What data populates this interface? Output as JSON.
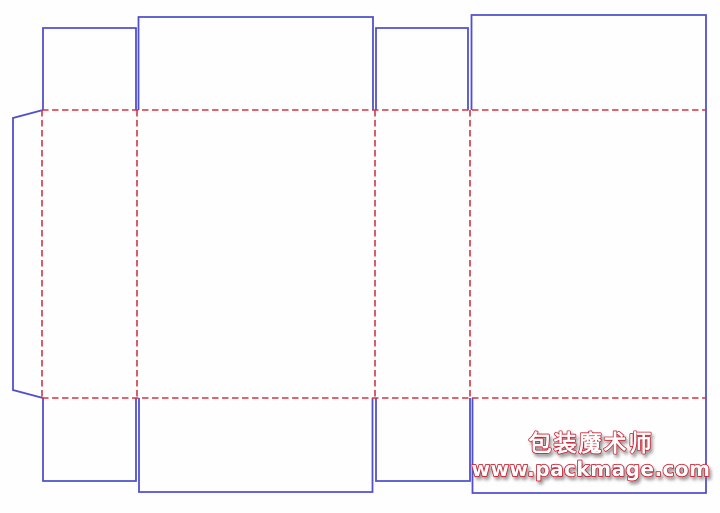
{
  "canvas": {
    "width": 720,
    "height": 513,
    "background": "#fefefe"
  },
  "colors": {
    "cut_line": "#5050cb",
    "fold_line": "#cf3745",
    "watermark_fill": "#ffffff",
    "watermark_outline": "#cc2233"
  },
  "dieline": {
    "stroke_width_cut": 1.8,
    "stroke_width_fold": 1.6,
    "fold_dash": "6.5 3.5",
    "cut_lines": [
      {
        "name": "glue-flap",
        "points": [
          [
            43,
            110
          ],
          [
            13,
            118
          ],
          [
            13,
            390
          ],
          [
            43,
            398
          ]
        ]
      },
      {
        "name": "top-dust-flap-left",
        "points": [
          [
            43,
            110
          ],
          [
            43,
            28
          ],
          [
            136,
            28
          ],
          [
            136,
            110
          ]
        ]
      },
      {
        "name": "top-tuck-flap-front",
        "points": [
          [
            138.5,
            110
          ],
          [
            138.5,
            17
          ],
          [
            373,
            17
          ],
          [
            373,
            110
          ]
        ]
      },
      {
        "name": "top-dust-flap-right",
        "points": [
          [
            376,
            110
          ],
          [
            376,
            28
          ],
          [
            468,
            28
          ],
          [
            468,
            110
          ]
        ]
      },
      {
        "name": "back-panel-outline",
        "points": [
          [
            471.5,
            110
          ],
          [
            471.5,
            15
          ],
          [
            706,
            15
          ],
          [
            706,
            493
          ],
          [
            472.5,
            493
          ],
          [
            472.5,
            398
          ]
        ]
      },
      {
        "name": "bottom-dust-flap-left",
        "points": [
          [
            43,
            398
          ],
          [
            43,
            481
          ],
          [
            136,
            481
          ],
          [
            136,
            398
          ]
        ]
      },
      {
        "name": "bottom-tuck-flap-front",
        "points": [
          [
            139,
            398
          ],
          [
            139,
            492
          ],
          [
            372.5,
            492
          ],
          [
            372.5,
            398
          ]
        ]
      },
      {
        "name": "bottom-dust-flap-right",
        "points": [
          [
            376,
            398
          ],
          [
            376,
            481
          ],
          [
            470,
            481
          ],
          [
            470,
            398
          ]
        ]
      }
    ],
    "fold_lines": [
      {
        "name": "fold-top-horizontal",
        "x1": 42,
        "y1": 110,
        "x2": 706,
        "y2": 110
      },
      {
        "name": "fold-bottom-horizontal",
        "x1": 42,
        "y1": 398,
        "x2": 706,
        "y2": 398
      },
      {
        "name": "fold-glue-flap",
        "x1": 42,
        "y1": 110,
        "x2": 42,
        "y2": 398
      },
      {
        "name": "fold-panel-1-2",
        "x1": 137,
        "y1": 110,
        "x2": 137,
        "y2": 398
      },
      {
        "name": "fold-panel-2-3",
        "x1": 375,
        "y1": 110,
        "x2": 375,
        "y2": 398
      },
      {
        "name": "fold-panel-3-4",
        "x1": 470,
        "y1": 110,
        "x2": 470,
        "y2": 398
      }
    ]
  },
  "watermark": {
    "brand": "包装魔术师",
    "url": "www.packmage.com",
    "center_x": 591,
    "brand_baseline_y": 451,
    "url_baseline_y": 476
  }
}
